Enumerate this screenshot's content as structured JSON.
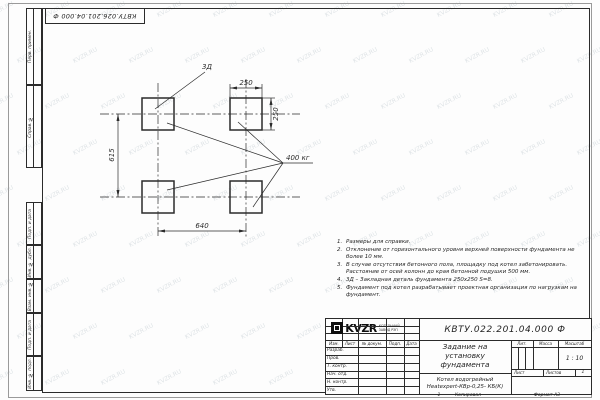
{
  "watermark": {
    "text": "KVZR.RU"
  },
  "top_stamp": {
    "doc_number": "КВТУ.026.201.04.000 Ф"
  },
  "frame_left": {
    "boxes": [
      "Перв. примен.",
      "Справ. №",
      "Подп. и дата",
      "Инв. № дубл.",
      "Взам. инв. №",
      "Подп. и дата",
      "Инв. № подл."
    ]
  },
  "drawing": {
    "embed_label": "3Д",
    "load_label": "400 кг",
    "dim_top": "250",
    "dim_right": "250",
    "dim_left": "615",
    "dim_bottom": "640"
  },
  "notes": [
    {
      "num": "1.",
      "text": "Размеры для справки."
    },
    {
      "num": "2.",
      "text": "Отклонение от горизонтального уровня верхней поверхности фундамента не более 10 мм."
    },
    {
      "num": "3.",
      "text": "В случае отсутствия бетонного пола, площадку под котел забетонировать. Расстояние от осей колонн до края бетонной подушки 500 мм."
    },
    {
      "num": "4.",
      "text": "3Д – Закладная деталь фундамента 250х250 S=8."
    },
    {
      "num": "5.",
      "text": "Фундамент под котел разрабатывает проектная организация по нагрузкам на фундамент."
    }
  ],
  "title_block": {
    "doc_number": "КВТУ.022.201.04.000 Ф",
    "title": "Задание на установку фундамента",
    "header_cols": [
      "Изм.",
      "Лист",
      "№ докум.",
      "Подп.",
      "Дата"
    ],
    "sign_rows": [
      "Разраб.",
      "Пров.",
      "Т. контр.",
      "Нач. отд.",
      "Н. контр.",
      "Утв."
    ],
    "lit_label": "Лит.",
    "mass_label": "Масса",
    "scale_label": "Масштаб",
    "scale_value": "1 : 10",
    "sheet_label": "Лист",
    "sheets_label": "Листов",
    "sheets_value": "1",
    "product_line1": "Котел водогрейный",
    "product_line2": "Heatexpert-КВр-0,25- КБ(К)",
    "logo": {
      "text": "KVZR",
      "sub1": "КОТЕЛЬНЫЙ",
      "sub2": "ЗАВОД РЭП"
    }
  },
  "footer": {
    "page": "1",
    "copied": "Копировал",
    "format": "Формат А3"
  },
  "colors": {
    "line": "#2b2b2b",
    "watermark": "#8fa0ab"
  }
}
